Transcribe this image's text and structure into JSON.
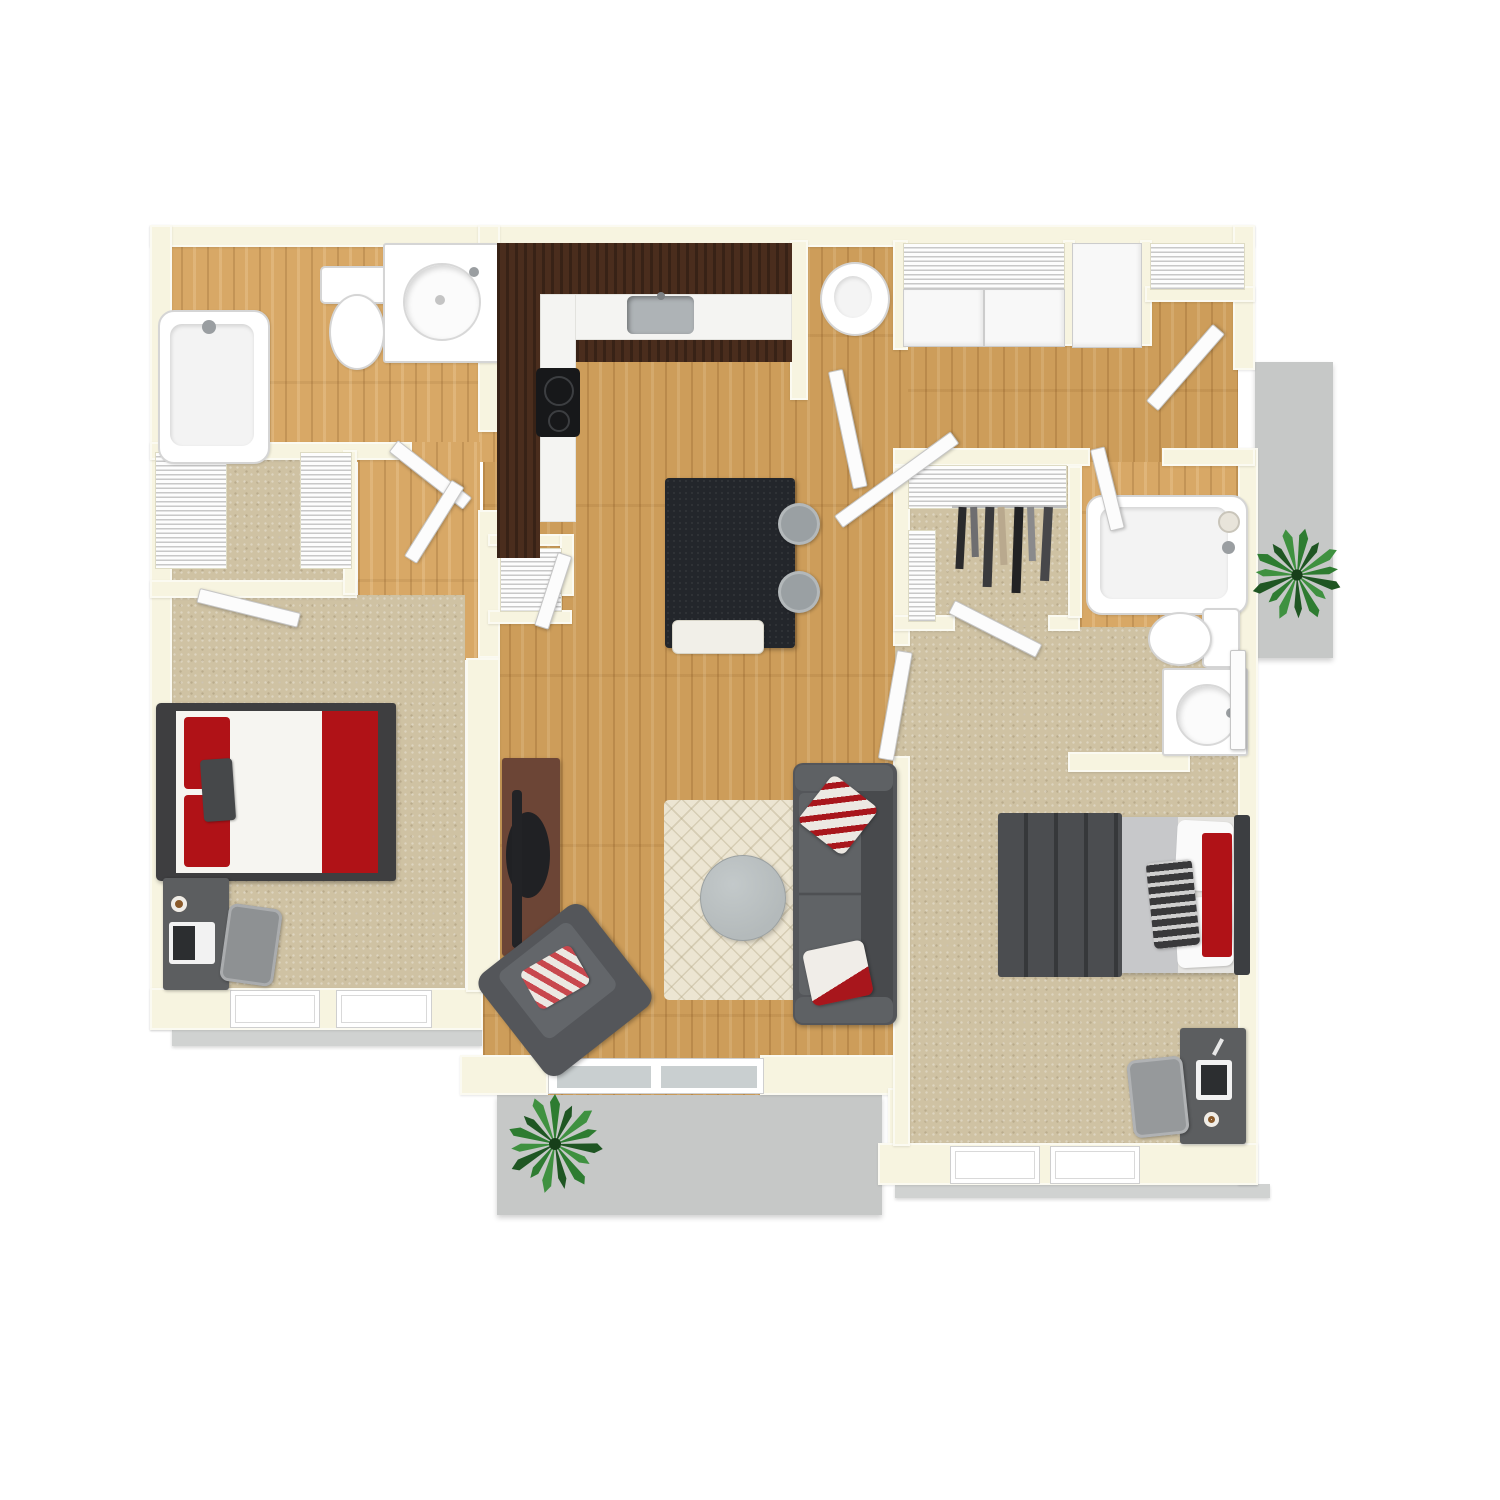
{
  "meta": {
    "description": "3D top-down rendered floor plan of a two-bedroom / two-bathroom apartment with open kitchen-living area, two walk-in closets, laundry closet, rear patio and entry landing",
    "visible_text": "none"
  },
  "palette": {
    "wall": "#f7f4e0",
    "wood": "#cd9d5a",
    "carpet": "#cfc2a3",
    "patio": "#c6c8c7",
    "ledge": "#d0d2d1",
    "counter_dark": "#4a2d1d",
    "counter_white": "#f4f4f2",
    "island": "#23262b",
    "steel": "#aeb3b6",
    "fixture_white": "#ffffff",
    "fixture_edge": "#d5d5d5",
    "sofa": "#54565a",
    "chair": "#8e9193",
    "cushion_red": "#b01217",
    "bed_frame": "#3e3e40",
    "duvet_white": "#f6f5f1",
    "blanket_gray": "#4b4d50",
    "sheet_gray": "#c7c8ca",
    "desk": "#5c5e60",
    "console_brown": "#6c4536",
    "tv_black": "#202124",
    "rug": "#ece5d2",
    "ottoman": "#b4babb",
    "plant": "#2e7c31",
    "plant_dark": "#1f5623",
    "door_white": "#fcfcfc",
    "glass": "#c9cfd0"
  },
  "scene": {
    "rooms": [
      {
        "id": "bathroom-1",
        "floor": "wood",
        "contents": [
          "bathtub",
          "toilet",
          "vanity-round-sink"
        ]
      },
      {
        "id": "walk-in-closet-1",
        "floor": "carpet",
        "contents": [
          "louvered-shelving"
        ]
      },
      {
        "id": "bedroom-1",
        "floor": "carpet",
        "contents": [
          "double-bed-white-duvet-red-pillows",
          "desk-with-laptop-and-mug",
          "desk-chair",
          "two-windows"
        ]
      },
      {
        "id": "coat-closet",
        "floor": "carpet",
        "contents": [
          "louvered-shelving"
        ]
      },
      {
        "id": "kitchen",
        "floor": "wood",
        "contents": [
          "u-shaped-dark-wood-counter",
          "steel-sink",
          "black-cooktop",
          "black-island",
          "two-barstools",
          "white-bench"
        ]
      },
      {
        "id": "laundry-closet",
        "floor": "wood",
        "contents": [
          "washer"
        ]
      },
      {
        "id": "hall-closets",
        "floor": "wood",
        "contents": [
          "bifold-louvered-closet",
          "shelf-closet",
          "linen-closet"
        ]
      },
      {
        "id": "entry",
        "floor": "wood",
        "contents": [
          "front-door",
          "entry-landing",
          "potted-plant"
        ]
      },
      {
        "id": "walk-in-closet-2",
        "floor": "carpet",
        "contents": [
          "hanging-rod-with-clothes",
          "louvered-shelving"
        ]
      },
      {
        "id": "bathroom-2",
        "floor": "wood",
        "contents": [
          "bathtub",
          "toilet",
          "vanity-round-sink"
        ]
      },
      {
        "id": "bedroom-2",
        "floor": "carpet",
        "contents": [
          "double-bed-gray-blanket-red-striped-pillows",
          "desk-with-monitor",
          "desk-chair",
          "two-windows"
        ]
      },
      {
        "id": "living-room",
        "floor": "wood",
        "contents": [
          "tv-console",
          "flat-tv",
          "gray-armchair-red-pillow",
          "diamond-pattern-rug",
          "round-ottoman",
          "gray-sofa-two-red-white-pillows",
          "sliding-glass-door"
        ]
      },
      {
        "id": "patio",
        "floor": "concrete",
        "contents": [
          "potted-plant"
        ]
      }
    ]
  }
}
